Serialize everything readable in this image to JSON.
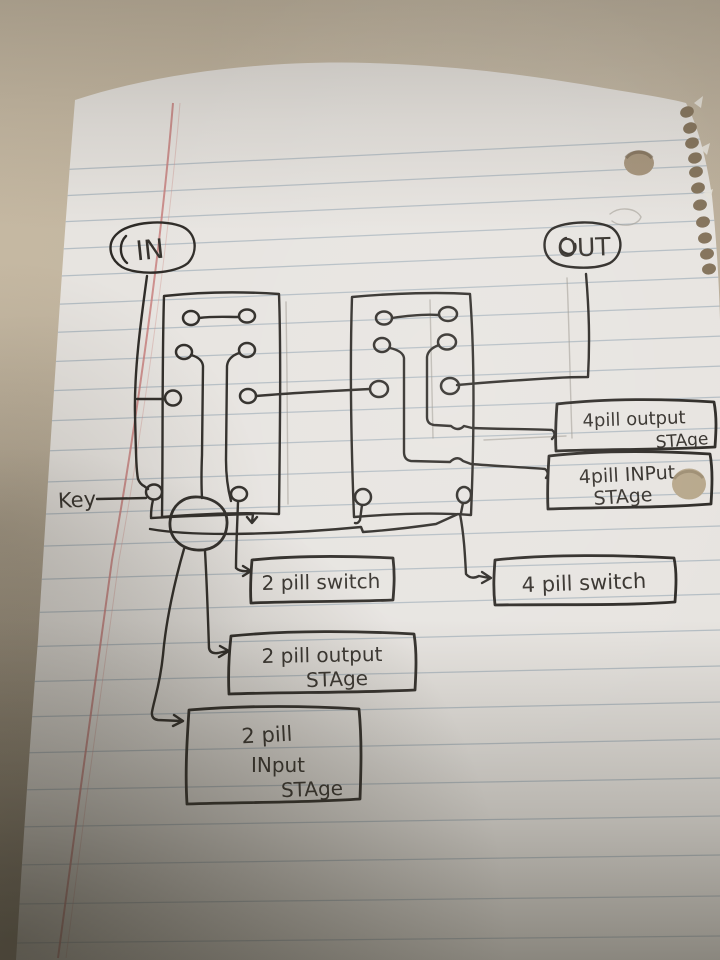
{
  "photo": {
    "description": "Hand-drawn electrical wiring diagram in black ink on ruled spiral-notebook paper, photographed on a tan desk"
  },
  "labels": {
    "in": "IN",
    "out": "OUT",
    "key": "Key",
    "switch_2pill": "2 pill switch",
    "switch_4pill": "4 pill switch",
    "output_2pill": {
      "line1": "2 pill output",
      "line2": "STAge"
    },
    "input_2pill": {
      "line1": "2 pill",
      "line2": "INput",
      "line3": "STAge"
    },
    "output_4pill": {
      "line1": "4pill output",
      "line2": "STAge"
    },
    "input_4pill": {
      "line1": "4pill INPut",
      "line2": "STAge"
    }
  },
  "colors": {
    "ink": "#2d2a26",
    "paper": "#e7e4e0",
    "desk": "#c6b9a3",
    "rule_line": "#a9b4bd",
    "margin_line": "#c77f7c"
  }
}
